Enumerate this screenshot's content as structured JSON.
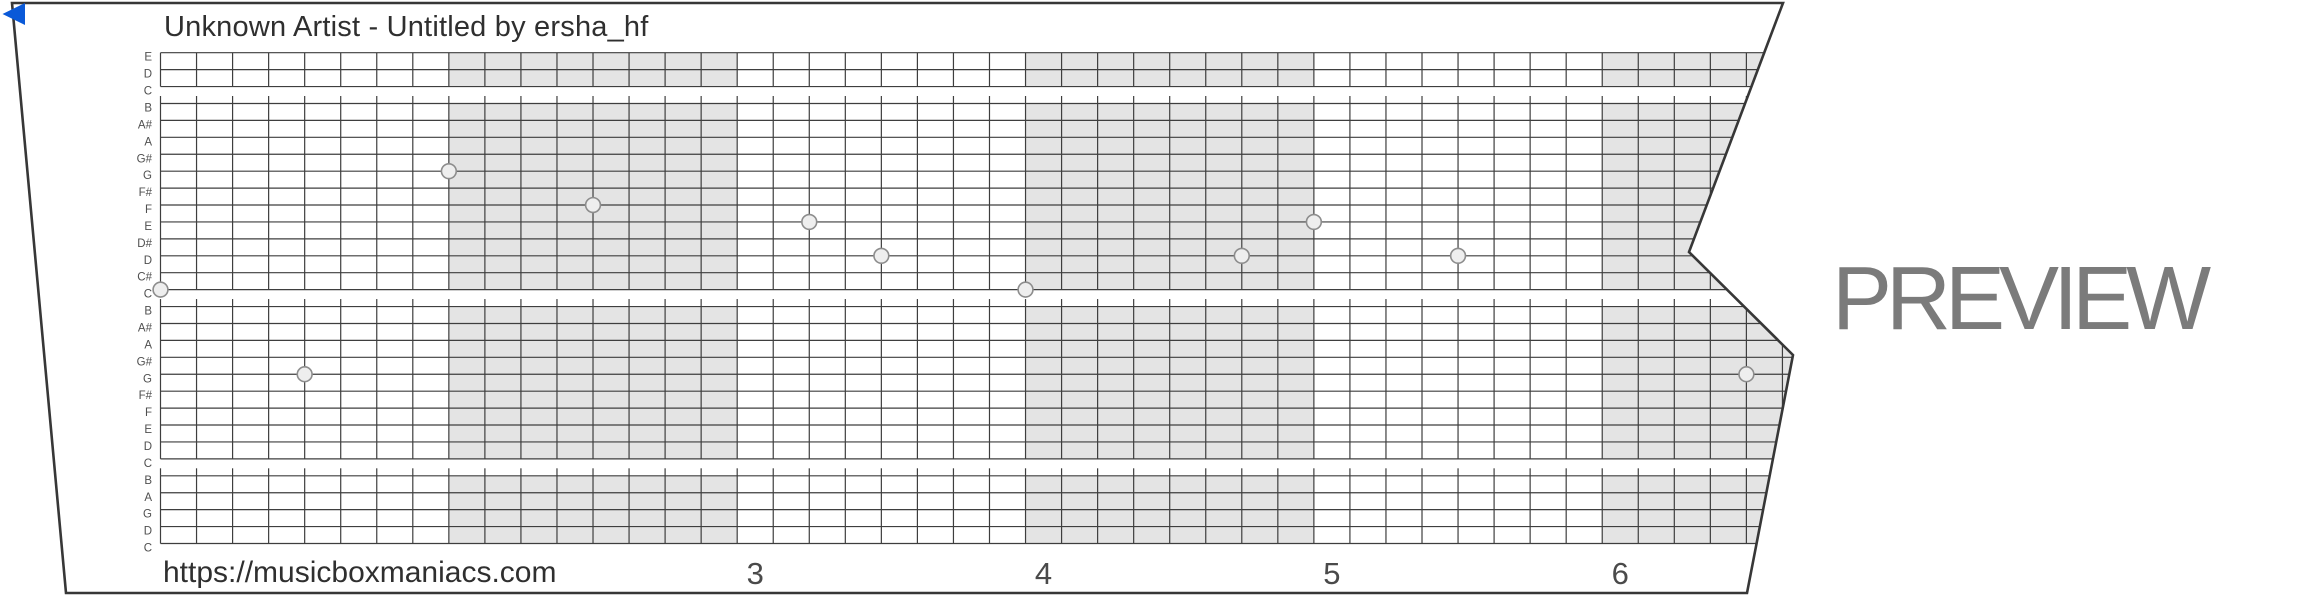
{
  "header": {
    "title": "Unknown Artist - Untitled by ersha_hf"
  },
  "watermark": {
    "text": "PREVIEW",
    "color": "#7b7b7b"
  },
  "footer": {
    "url": "https://musicboxmaniacs.com"
  },
  "icons": {
    "back_arrow_color": "#0a59d8"
  },
  "strip": {
    "colors": {
      "outline": "#373737",
      "grid_line": "#3e3e3e",
      "shade": "#e4e4e4",
      "dot_fill": "#eeeeee",
      "dot_stroke": "#8d8d8d",
      "label_color": "#4f4f4f",
      "number_color": "#4a4a4a"
    },
    "note_labels": [
      "E",
      "D",
      "C",
      "B",
      "A#",
      "A",
      "G#",
      "G",
      "F#",
      "F",
      "E",
      "D#",
      "D",
      "C#",
      "C",
      "B",
      "A#",
      "A",
      "G#",
      "G",
      "F#",
      "F",
      "E",
      "D",
      "C",
      "B",
      "A",
      "G",
      "D",
      "C"
    ],
    "octave_break_rows": [
      2,
      14,
      24
    ],
    "shaded_measures": [
      2,
      4,
      6
    ],
    "beats_per_measure": 8,
    "measure_numbers": [
      {
        "measure": 3,
        "label": "3"
      },
      {
        "measure": 4,
        "label": "4"
      },
      {
        "measure": 5,
        "label": "5"
      },
      {
        "measure": 6,
        "label": "6"
      }
    ],
    "notes": [
      {
        "pitch": "C",
        "row": 14,
        "beat": 0
      },
      {
        "pitch": "G",
        "row": 19,
        "beat": 4
      },
      {
        "pitch": "G",
        "row": 7,
        "beat": 8
      },
      {
        "pitch": "F",
        "row": 9,
        "beat": 12
      },
      {
        "pitch": "E",
        "row": 10,
        "beat": 18
      },
      {
        "pitch": "D",
        "row": 12,
        "beat": 20
      },
      {
        "pitch": "C",
        "row": 14,
        "beat": 24
      },
      {
        "pitch": "D",
        "row": 12,
        "beat": 30
      },
      {
        "pitch": "E",
        "row": 10,
        "beat": 32
      },
      {
        "pitch": "D",
        "row": 12,
        "beat": 36
      },
      {
        "pitch": "G",
        "row": 19,
        "beat": 44
      }
    ]
  }
}
